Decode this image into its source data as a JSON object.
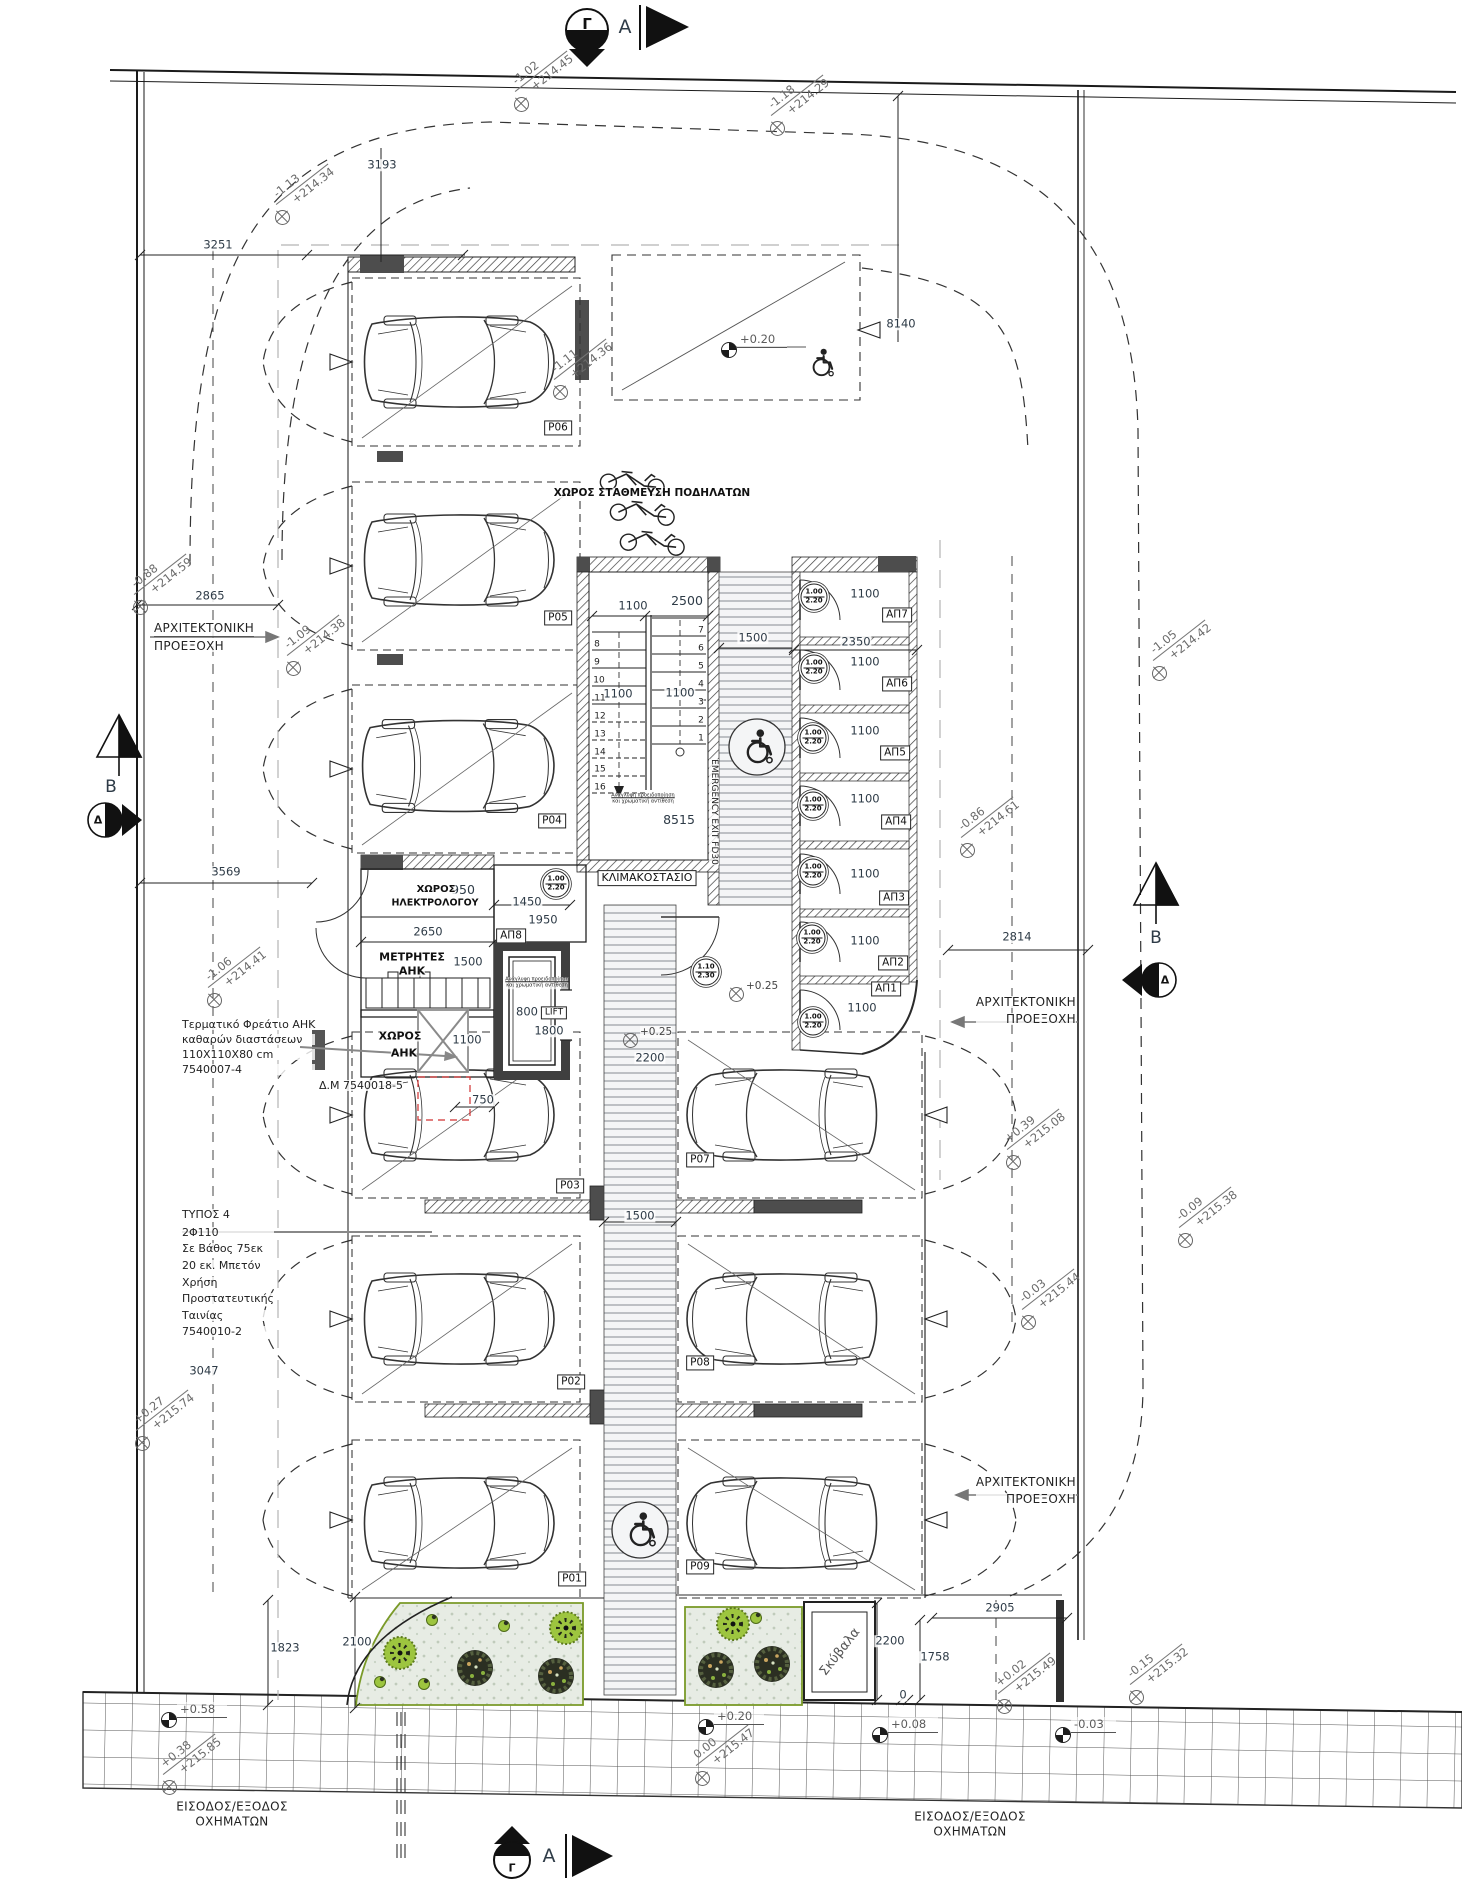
{
  "markers": {
    "gamma_top": "Γ",
    "a_top": "A",
    "gamma_bottom": "Γ",
    "a_bottom": "A",
    "b_left": "B",
    "b_right": "B",
    "delta_left": "Δ",
    "delta_right": "Δ"
  },
  "spots": {
    "s1": {
      "value": "-1.02",
      "elev": "+214.45"
    },
    "s2": {
      "value": "-1.13",
      "elev": "+214.34"
    },
    "s3": {
      "value": "-1.18",
      "elev": "+214.29"
    },
    "s4": {
      "value": "-1.11",
      "elev": "+214.36"
    },
    "s5": {
      "value": "-1.09",
      "elev": "+214.38"
    },
    "s6": {
      "value": "-0.88",
      "elev": "+214.59"
    },
    "s7": {
      "value": "-1.06",
      "elev": "+214.41"
    },
    "s8": {
      "value": "-1.05",
      "elev": "+214.42"
    },
    "s9": {
      "value": "-0.86",
      "elev": "+214.61"
    },
    "s10": {
      "value": "+0.27",
      "elev": "+215.74"
    },
    "s11": {
      "value": "+0.39",
      "elev": "+215.08"
    },
    "s12": {
      "value": "-0.09",
      "elev": "+215.38"
    },
    "s13": {
      "value": "-0.03",
      "elev": "+215.44"
    },
    "s14": {
      "value": "+0.02",
      "elev": "+215.49"
    },
    "s15": {
      "value": "-0.15",
      "elev": "+215.32"
    },
    "s16": {
      "value": "+0.38",
      "elev": "+215.85"
    },
    "s17": {
      "value": "0.00",
      "elev": "+215.47"
    }
  },
  "benchmarks": {
    "top": "+0.20",
    "bottom": "+0.20",
    "left": "+0.58",
    "mid": "+0.08",
    "right": "-0.03"
  },
  "plus25": "+0.25",
  "dims": {
    "d3193": "3193",
    "d3251": "3251",
    "d8140": "8140",
    "d2865": "2865",
    "d3569": "3569",
    "d950": "950",
    "d1450": "1450",
    "d1950": "1950",
    "d2650": "2650",
    "d1500m": "1500",
    "d800": "800",
    "d1800": "1800",
    "d1100ahk": "1100",
    "d750": "750",
    "d2200l": "2200",
    "d1100s": "1100",
    "d2500": "2500",
    "d2350": "2350",
    "d1500c": "1500",
    "d1100L": "1100",
    "d1100R": "1100",
    "d8515": "8515",
    "room1100": "1100",
    "d2814": "2814",
    "d2905": "2905",
    "d2200b": "2200",
    "d1758": "1758",
    "d0": "0",
    "d1823": "1823",
    "d2100": "2100",
    "d3047": "3047",
    "d1500w": "1500"
  },
  "parking": {
    "p01": "P01",
    "p02": "P02",
    "p03": "P03",
    "p04": "P04",
    "p05": "P05",
    "p06": "P06",
    "p07": "P07",
    "p08": "P08",
    "p09": "P09"
  },
  "storage": {
    "ap1": "ΑΠ1",
    "ap2": "ΑΠ2",
    "ap3": "ΑΠ3",
    "ap4": "ΑΠ4",
    "ap5": "ΑΠ5",
    "ap6": "ΑΠ6",
    "ap7": "ΑΠ7",
    "ap8": "ΑΠ8"
  },
  "rooms": {
    "stair": "ΚΛΙΜΑΚΟΣΤΑΣΙΟ",
    "elec1": "ΧΩΡΟΣ",
    "elec2": "ΗΛΕΚΤΡΟΛΟΓΟΥ",
    "met1": "ΜΕΤΡΗΤΕΣ",
    "met2": "ΑΗΚ",
    "ahk1": "ΧΩΡΟΣ",
    "ahk2": "ΑΗΚ",
    "lift": "LIFT",
    "garbage": "Σκύβαλα",
    "bikes": "ΧΩΡΟΣ ΣΤΑΘΜΕΥΣΗ ΠΟΔΗΛΑΤΩΝ",
    "emergency": "EMERGENCY EXIT FD30"
  },
  "doors": {
    "std_top": "1.00",
    "std_bot": "2.20",
    "alt_top": "1.10",
    "alt_bot": "2.30"
  },
  "labels": {
    "proex1": "ΑΡΧΙΤΕΚΤΟΝΙΚΗ",
    "proex2": "ΠΡΟΕΞΟΧΗ",
    "entry1": "ΕΙΣΟΔΟΣ/ΕΞΟΔΟΣ",
    "entry2": "ΟΧΗΜΑΤΩΝ"
  },
  "notes": {
    "terminal": [
      "Τερματικό Φρεάτιο ΑΗΚ",
      "καθαρών διαστάσεων",
      "110X110X80 cm",
      "7540007-4"
    ],
    "dm": "Δ.Μ 7540018-5",
    "typos": [
      "ΤΥΠΟΣ 4",
      "2Φ110",
      "Σε Βάθος 75εκ",
      "20 εκ. Μπετόν",
      "Χρήση",
      "Προστατευτικής",
      "Ταινίας",
      "7540010-2"
    ],
    "tactile1": "Ανάγλυφη προειδοποίηση",
    "tactile2": "και χρωματική αντίθεση"
  },
  "stairs": {
    "left": [
      "8",
      "9",
      "10",
      "11",
      "12",
      "13",
      "14",
      "15",
      "16"
    ],
    "right": [
      "7",
      "6",
      "5",
      "4",
      "3",
      "2",
      "1"
    ]
  }
}
